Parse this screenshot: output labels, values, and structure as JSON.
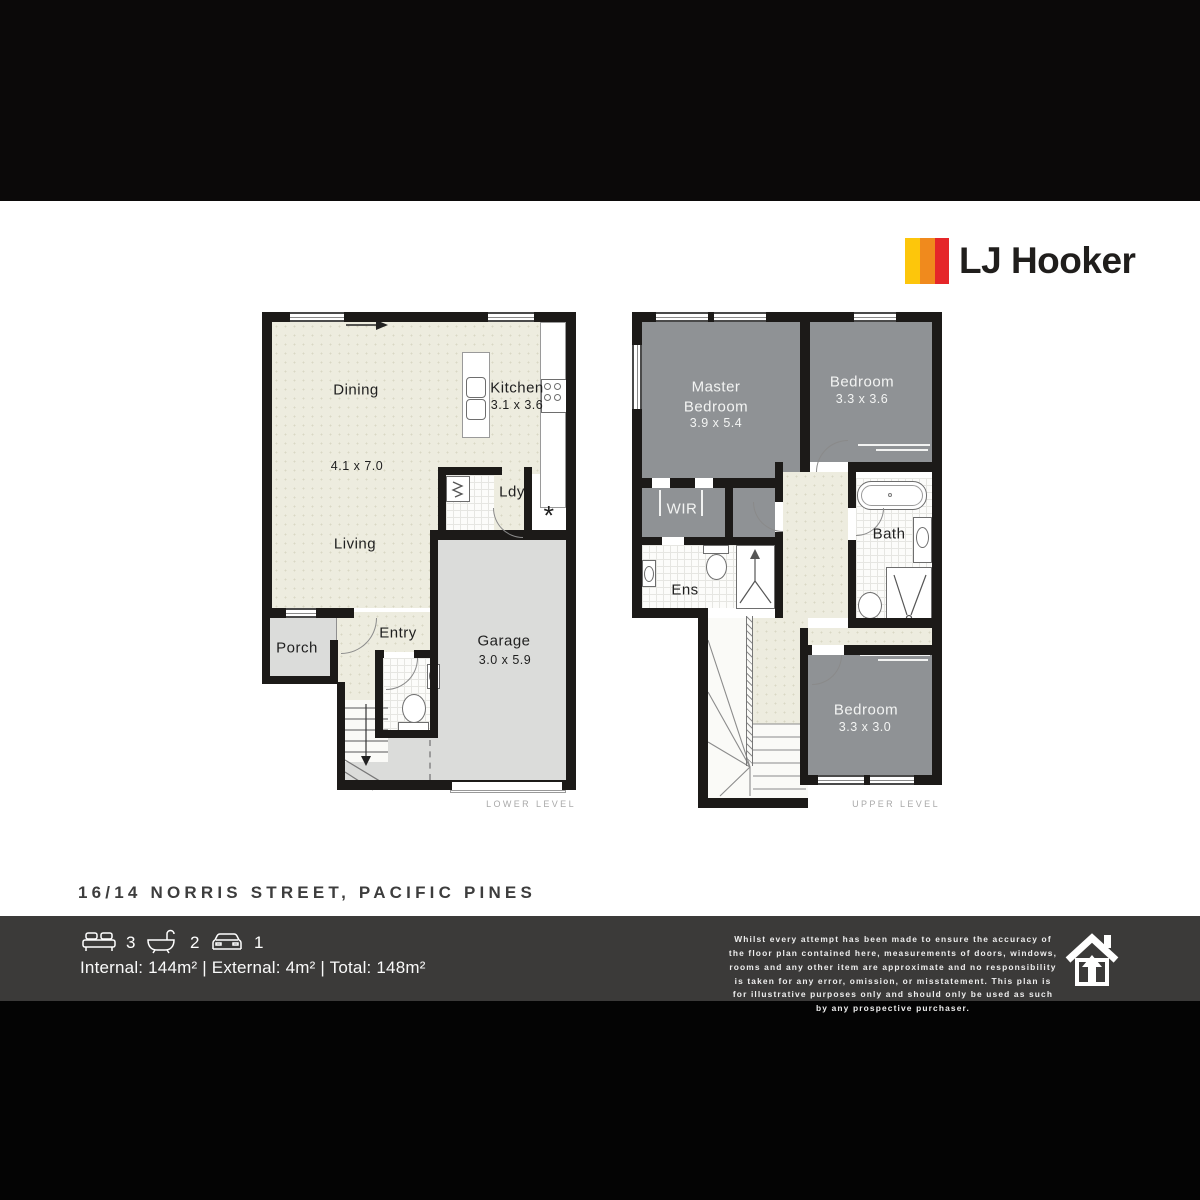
{
  "header": {
    "brand": "LJ Hooker",
    "brand_colors": {
      "yellow": "#FDC60B",
      "orange": "#F08A1D",
      "red": "#E52629"
    }
  },
  "address": "16/14 NORRIS STREET, PACIFIC PINES",
  "lower": {
    "level_label": "LOWER LEVEL",
    "dining": "Dining",
    "dining_dims": "4.1 x 7.0",
    "living": "Living",
    "kitchen": "Kitchen",
    "kitchen_dims": "3.1 x 3.6",
    "laundry": "Ldy",
    "hw_symbol": "*",
    "entry": "Entry",
    "porch": "Porch",
    "garage": "Garage",
    "garage_dims": "3.0 x 5.9"
  },
  "upper": {
    "level_label": "UPPER LEVEL",
    "master": "Master Bedroom",
    "master_dims": "3.9 x 5.4",
    "bedroom2": "Bedroom",
    "bedroom2_dims": "3.3 x 3.6",
    "bedroom3": "Bedroom",
    "bedroom3_dims": "3.3 x 3.0",
    "wir": "WIR",
    "ens": "Ens",
    "bath": "Bath"
  },
  "footer": {
    "beds": "3",
    "baths": "2",
    "cars": "1",
    "areas": "Internal: 144m² | External: 4m² | Total: 148m²",
    "disclaimer": "Whilst every attempt has been made to ensure the accuracy of the floor plan contained here, measurements of doors, windows, rooms and any other item are approximate and no responsibility is taken for any error, omission, or misstatement. This plan is for illustrative purposes only and should only be used as such by any prospective purchaser."
  }
}
